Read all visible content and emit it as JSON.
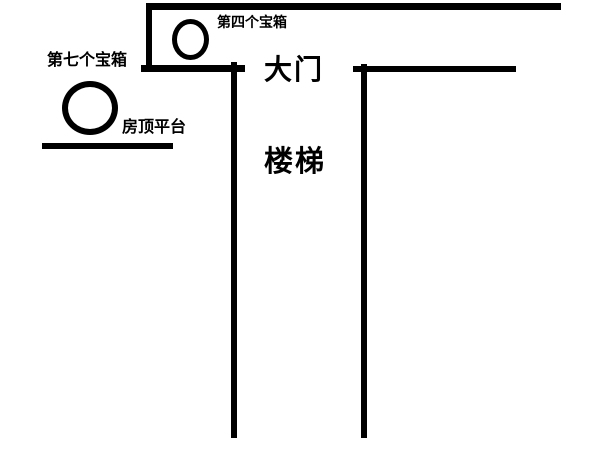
{
  "diagram": {
    "background": "#ffffff",
    "ink_color": "#000000",
    "labels": {
      "fourth_chest": "第四个宝箱",
      "seventh_chest": "第七个宝箱",
      "roof_platform": "房顶平台",
      "gate": "大门",
      "stairs": "楼梯"
    }
  }
}
